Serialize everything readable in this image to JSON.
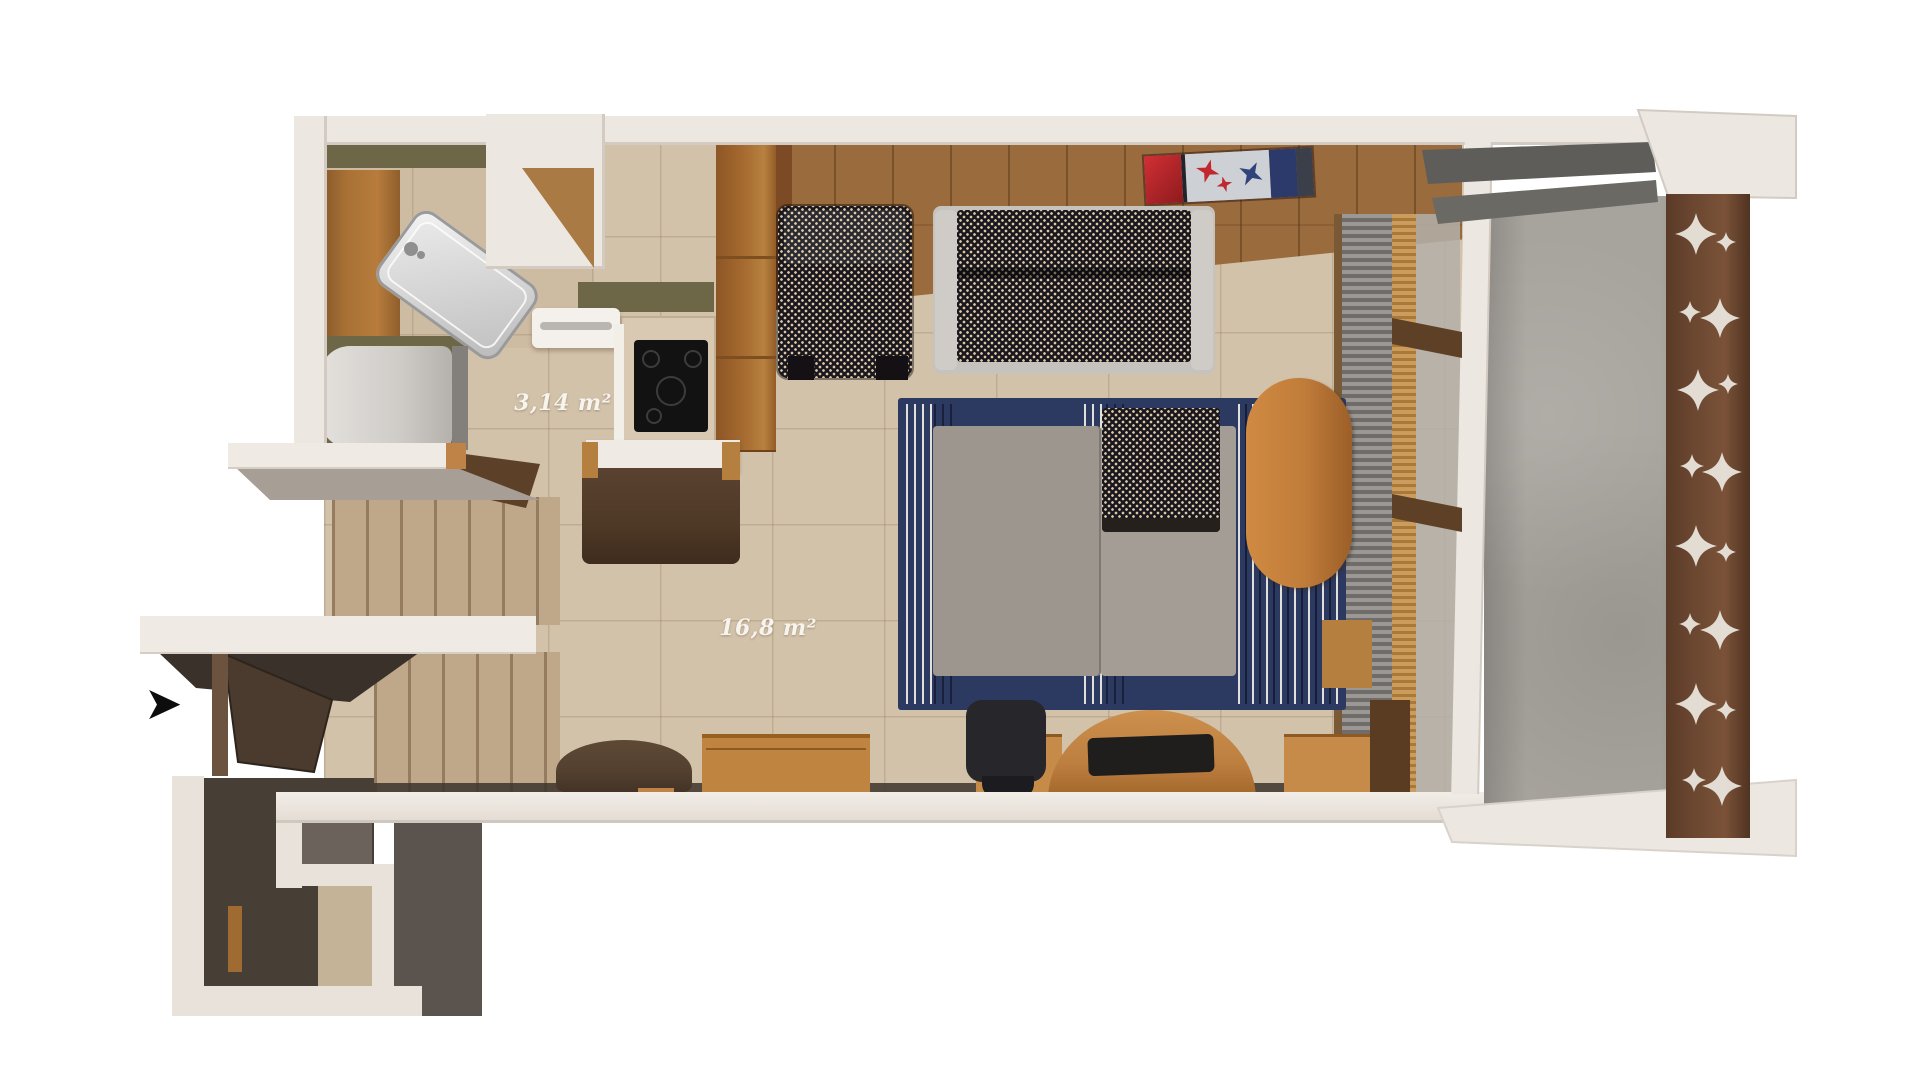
{
  "page": {
    "background": "#ffffff",
    "type": "3D rendered floor plan, top-down view"
  },
  "labels": {
    "bathroom_area": "3,14 m²",
    "main_area": "16,8 m²"
  },
  "entry": {
    "arrow_glyph": "➤"
  },
  "colors": {
    "wall": "#ece7e1",
    "tile_floor": "#d3c2aa",
    "wood_floor": "#9a6b3c",
    "olive_wall": "#6e6747",
    "navy_bed_rug": "#2c3960",
    "mattress_gray": "#9d968e",
    "upholstery_dark": "#1a1720",
    "upholstery_speckle": "#d9c9a2",
    "wood_furniture": "#bf8440",
    "dark_walnut": "#4e3826",
    "balcony_concrete": "#a7a39d",
    "screen_wood": "#6a4630",
    "kilim_red": "#b32024",
    "kilim_navy": "#2b3a6b",
    "arrow_black": "#0d0d0d"
  }
}
